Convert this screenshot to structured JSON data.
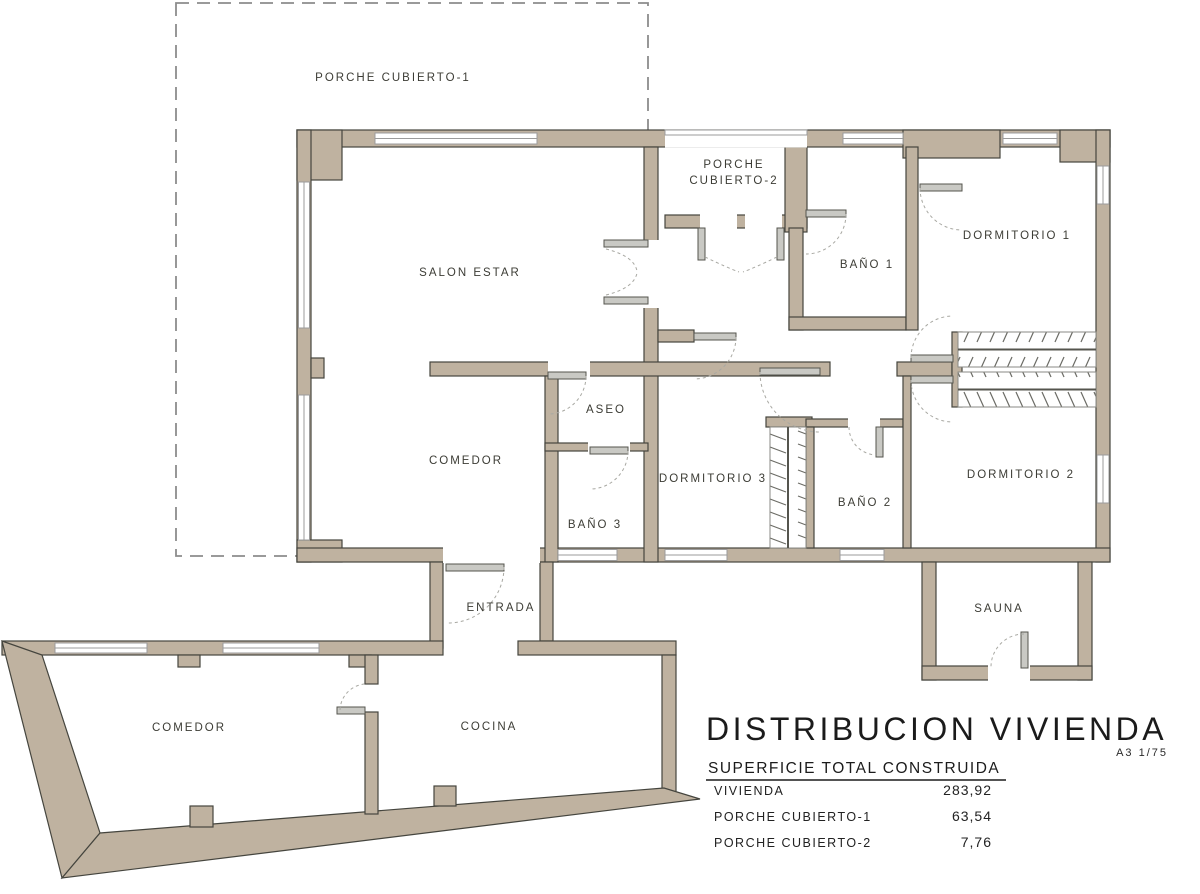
{
  "plan": {
    "labels": {
      "porche1": "PORCHE CUBIERTO-1",
      "porche2_line1": "PORCHE",
      "porche2_line2": "CUBIERTO-2",
      "salon": "SALON ESTAR",
      "comedor_superior": "COMEDOR",
      "aseo": "ASEO",
      "bano1": "BAÑO 1",
      "bano2": "BAÑO 2",
      "bano3": "BAÑO 3",
      "dormitorio1": "DORMITORIO 1",
      "dormitorio2": "DORMITORIO 2",
      "dormitorio3": "DORMITORIO 3",
      "entrada": "ENTRADA",
      "sauna": "SAUNA",
      "comedor_inferior": "COMEDOR",
      "cocina": "COCINA"
    },
    "colors": {
      "wall_fill": "#bfb2a0",
      "wall_outline": "#45453e",
      "window_line": "#9b9b9b",
      "door_arc": "#a8a8a2",
      "dashed_outline": "#8c8c8c",
      "label_text": "#3c3c35",
      "title_text": "#1b1b1b"
    }
  },
  "title_block": {
    "title": "DISTRIBUCION VIVIENDA",
    "scale_note": "A3 1/75",
    "table_header": "SUPERFICIE TOTAL CONSTRUIDA",
    "rows": [
      {
        "label": "VIVIENDA",
        "value": "283,92"
      },
      {
        "label": "PORCHE CUBIERTO-1",
        "value": "63,54"
      },
      {
        "label": "PORCHE CUBIERTO-2",
        "value": "7,76"
      }
    ]
  }
}
